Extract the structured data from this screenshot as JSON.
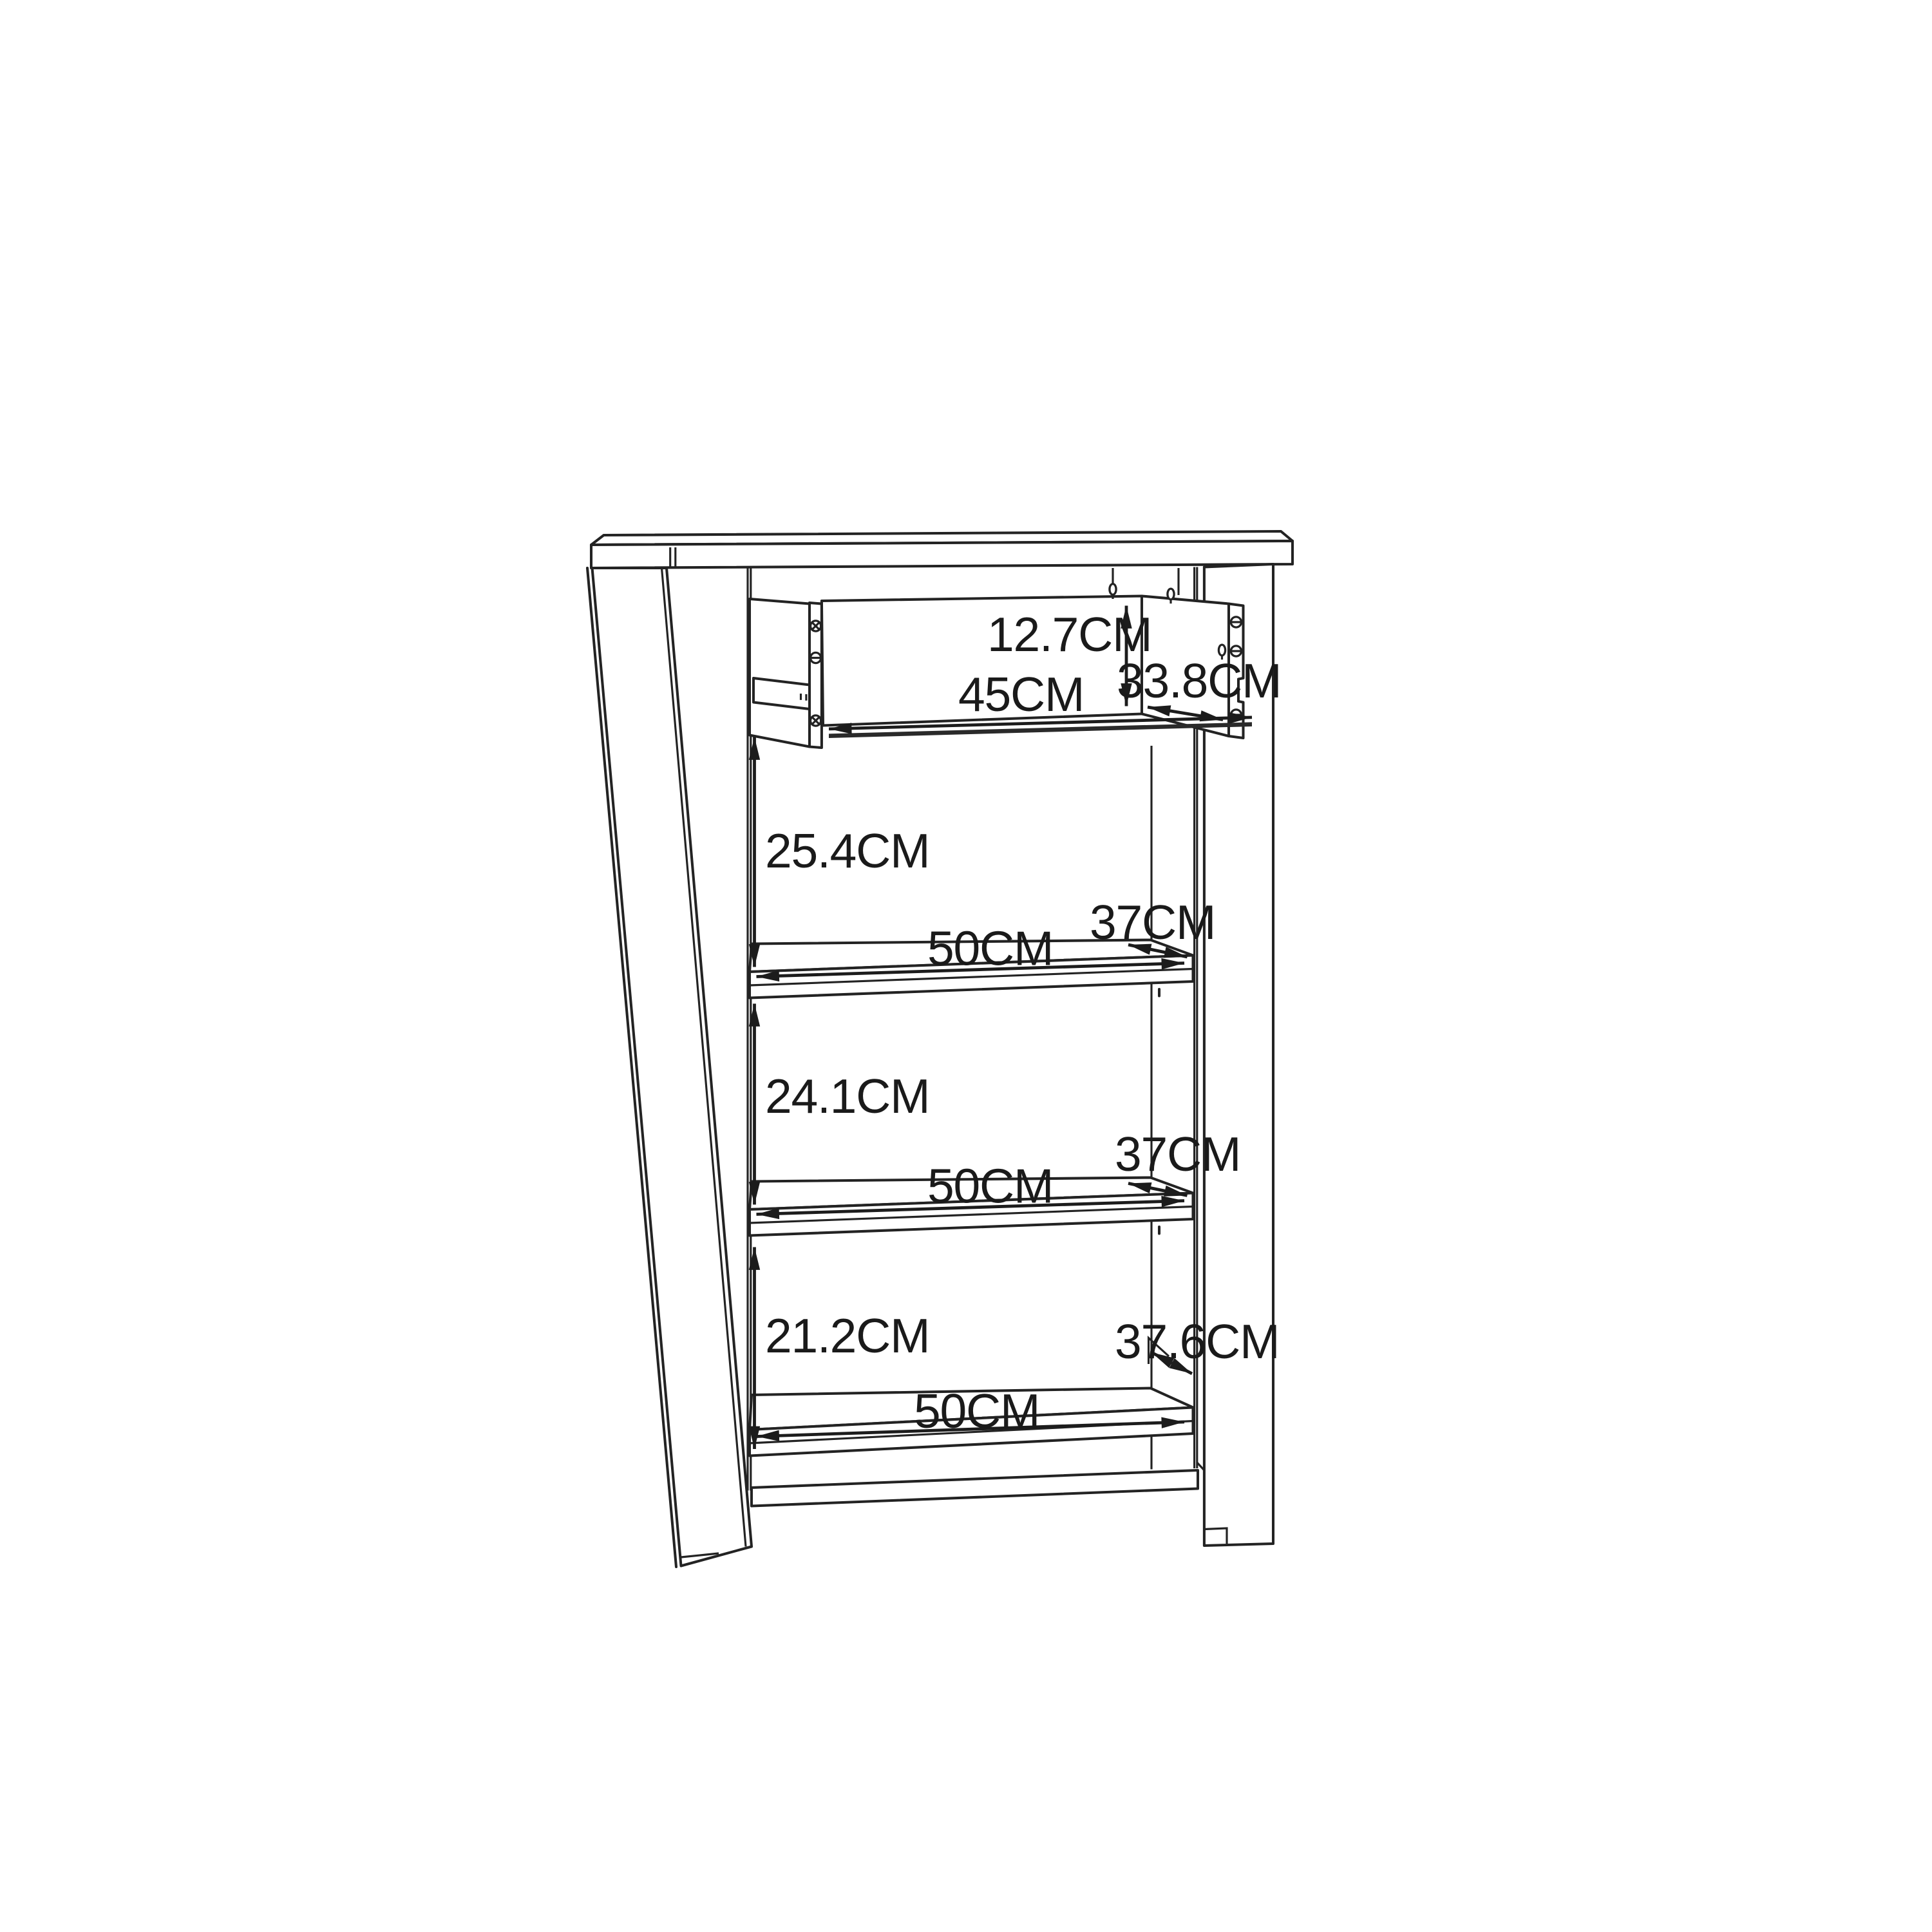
{
  "diagram": {
    "kind": "furniture-dimension-drawing",
    "subject": "shelf cabinet with pulled-out drawer and three open shelf compartments",
    "units": "CM",
    "colors": {
      "background": "#ffffff",
      "line": "#232323",
      "text": "#1a1a1a"
    },
    "dimensions": {
      "drawer": {
        "height_cm": 12.7,
        "width_cm": 45,
        "depth_cm": 33.8
      },
      "compartments": [
        {
          "height_cm": 25.4,
          "shelf_width_cm": 50,
          "shelf_depth_cm": 37
        },
        {
          "height_cm": 24.1,
          "shelf_width_cm": 50,
          "shelf_depth_cm": 37
        },
        {
          "height_cm": 21.2,
          "shelf_width_cm": 50,
          "shelf_depth_cm": 37.6
        }
      ]
    },
    "labels": {
      "drawer_height": {
        "text": "12.7CM"
      },
      "drawer_width": {
        "text": "45CM"
      },
      "drawer_depth": {
        "text": "33.8CM"
      },
      "gap1": {
        "text": "25.4CM"
      },
      "shelf1_width": {
        "text": "50CM"
      },
      "shelf1_depth": {
        "text": "37CM"
      },
      "gap2": {
        "text": "24.1CM"
      },
      "shelf2_width": {
        "text": "50CM"
      },
      "shelf2_depth": {
        "text": "37CM"
      },
      "gap3": {
        "text": "21.2CM"
      },
      "shelf3_width": {
        "text": "50CM"
      },
      "shelf3_depth": {
        "text": "37.6CM"
      }
    }
  }
}
